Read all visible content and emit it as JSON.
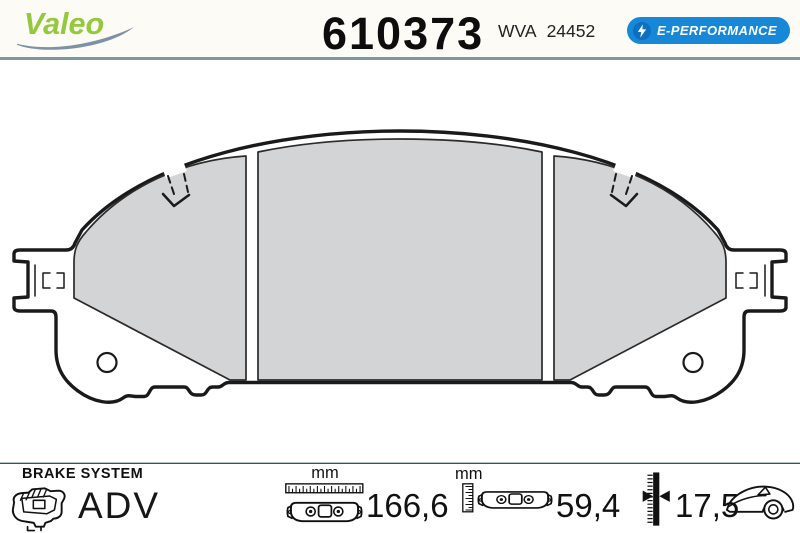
{
  "header": {
    "brand_logo": "Valeo",
    "part_number": "610373",
    "wva_label": "WVA",
    "wva_number": "24452",
    "badge_label": "E-PERFORMANCE",
    "badge_icon": "lightning-bolt-icon"
  },
  "drawing": {
    "name": "brake-pad-front-view-technical-drawing",
    "pad_fill_color": "#d2d4d6",
    "line_color": "#1a1a1a"
  },
  "footer": {
    "system_label": "BRAKE SYSTEM",
    "range_label": "ADV",
    "system_icon": "brake-caliper-icon",
    "specs": [
      {
        "id": "width",
        "unit": "mm",
        "value": "166,6",
        "icon": "horizontal-ruler-icon + pad-front-icon"
      },
      {
        "id": "height",
        "unit": "mm",
        "value": "59,4",
        "icon": "vertical-ruler-icon + pad-front-icon"
      },
      {
        "id": "thickness",
        "unit": "",
        "value": "17,5",
        "icon": "thickness-gauge-icon"
      }
    ],
    "vehicle_icon": "car-icon"
  },
  "colors": {
    "brand_green": "#94c83d",
    "swoosh_blue_gray": "#7e92a6",
    "badge_blue": "#1788d7",
    "badge_bolt_circle_blue": "#0c6fc0",
    "header_divider": "#7f979e",
    "footer_divider_dark": "#30525c",
    "footer_divider_light": "#b9c6ca",
    "pad_gray": "#d2d4d6"
  }
}
